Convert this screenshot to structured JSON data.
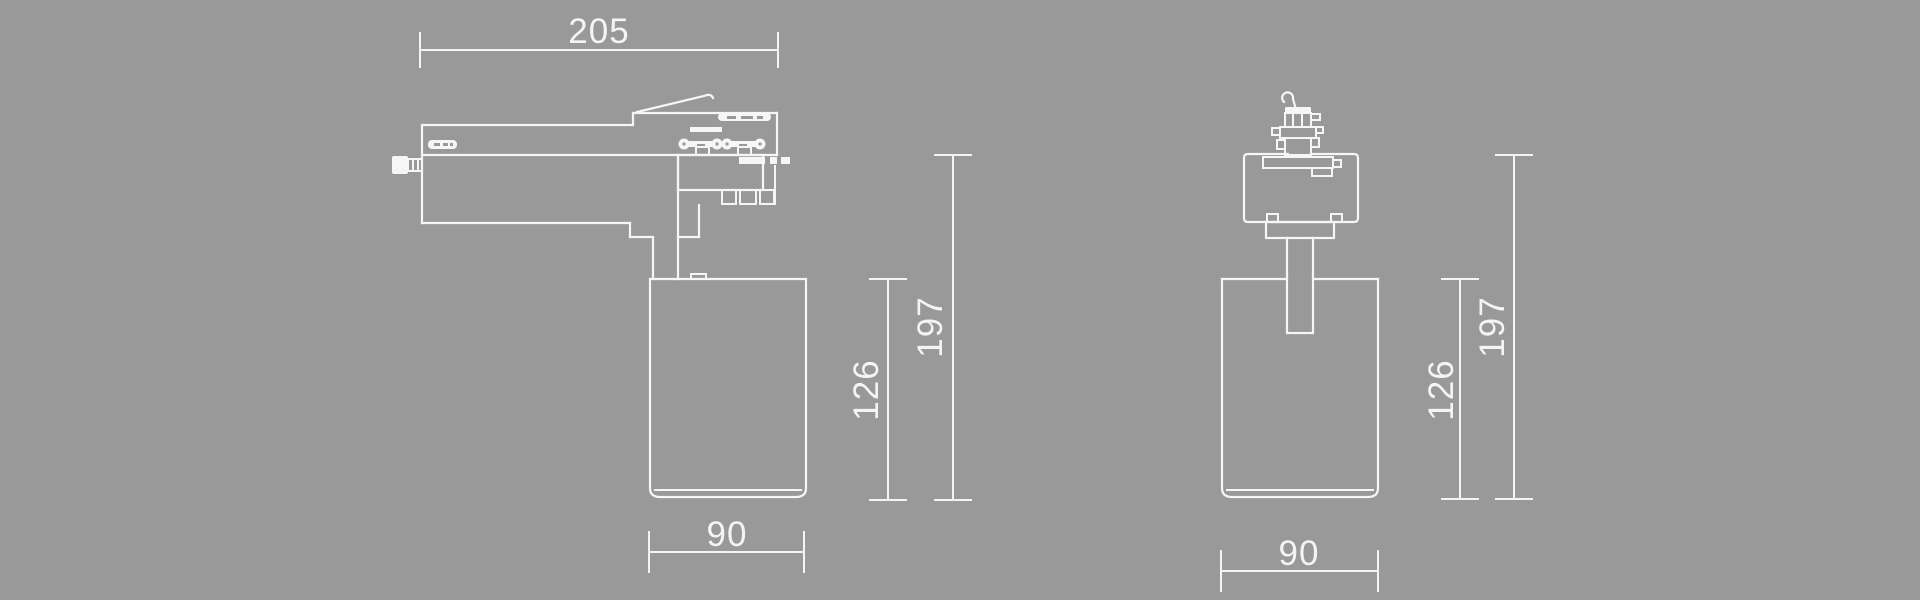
{
  "drawing": {
    "type": "technical-dimension-drawing",
    "subject": "track-light-spotlight",
    "background_color": "#999999",
    "line_color": "#f6f6f6",
    "text_color": "#f4f4f4",
    "views": {
      "side": {
        "label": "side-view",
        "dim_track_width": "205",
        "dim_head_width": "90",
        "dim_head_height": "126",
        "dim_overall_height": "197"
      },
      "front": {
        "label": "front-view",
        "dim_head_width": "90",
        "dim_head_height": "126",
        "dim_overall_height": "197"
      }
    }
  }
}
